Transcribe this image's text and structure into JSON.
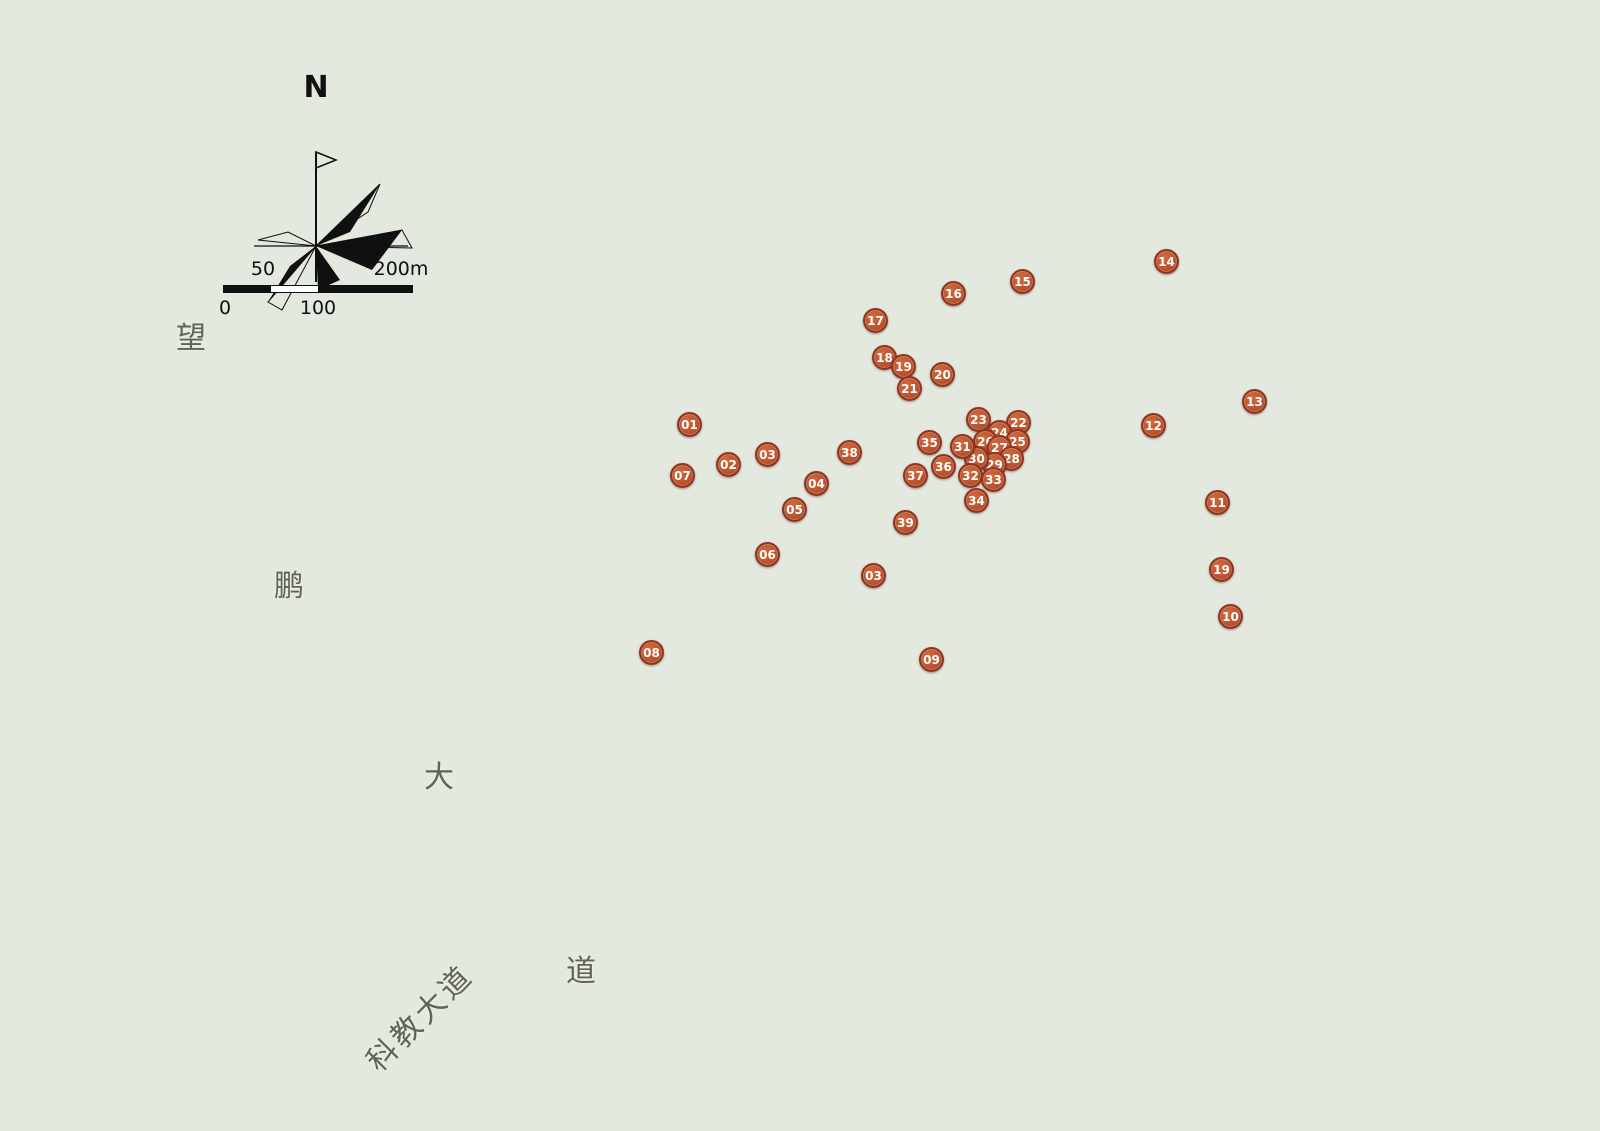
{
  "compass": {
    "north_label": "N"
  },
  "scale_bar": {
    "top_left_label": "50",
    "top_right_label": "200m",
    "bottom_left_label": "0",
    "bottom_mid_label": "100"
  },
  "road_labels": [
    {
      "id": "wang",
      "text": "望",
      "x": 193,
      "y": 335,
      "rotation": 0
    },
    {
      "id": "peng",
      "text": "鹏",
      "x": 291,
      "y": 583,
      "rotation": 0
    },
    {
      "id": "da",
      "text": "大",
      "x": 441,
      "y": 774,
      "rotation": 0
    },
    {
      "id": "dao",
      "text": "道",
      "x": 583,
      "y": 968,
      "rotation": 0
    },
    {
      "id": "kejiao-avenue",
      "text": "科教大道",
      "x": 418,
      "y": 1016,
      "rotation": -45
    }
  ],
  "markers": [
    {
      "label": "01",
      "x": 690,
      "y": 425
    },
    {
      "label": "02",
      "x": 729,
      "y": 465
    },
    {
      "label": "03",
      "x": 768,
      "y": 455
    },
    {
      "label": "03",
      "x": 874,
      "y": 576
    },
    {
      "label": "04",
      "x": 817,
      "y": 484
    },
    {
      "label": "05",
      "x": 795,
      "y": 510
    },
    {
      "label": "06",
      "x": 768,
      "y": 555
    },
    {
      "label": "07",
      "x": 683,
      "y": 476
    },
    {
      "label": "08",
      "x": 652,
      "y": 653
    },
    {
      "label": "09",
      "x": 932,
      "y": 660
    },
    {
      "label": "10",
      "x": 1231,
      "y": 617
    },
    {
      "label": "11",
      "x": 1218,
      "y": 503
    },
    {
      "label": "12",
      "x": 1154,
      "y": 426
    },
    {
      "label": "13",
      "x": 1255,
      "y": 402
    },
    {
      "label": "14",
      "x": 1167,
      "y": 262
    },
    {
      "label": "15",
      "x": 1023,
      "y": 282
    },
    {
      "label": "16",
      "x": 954,
      "y": 294
    },
    {
      "label": "17",
      "x": 876,
      "y": 321
    },
    {
      "label": "18",
      "x": 885,
      "y": 358
    },
    {
      "label": "19",
      "x": 904,
      "y": 367
    },
    {
      "label": "19",
      "x": 1222,
      "y": 570
    },
    {
      "label": "20",
      "x": 943,
      "y": 375
    },
    {
      "label": "21",
      "x": 910,
      "y": 389
    },
    {
      "label": "22",
      "x": 1019,
      "y": 423
    },
    {
      "label": "23",
      "x": 979,
      "y": 420
    },
    {
      "label": "24",
      "x": 1000,
      "y": 433
    },
    {
      "label": "25",
      "x": 1018,
      "y": 442
    },
    {
      "label": "26",
      "x": 986,
      "y": 442
    },
    {
      "label": "27",
      "x": 1000,
      "y": 448
    },
    {
      "label": "28",
      "x": 1012,
      "y": 459
    },
    {
      "label": "29",
      "x": 995,
      "y": 465
    },
    {
      "label": "30",
      "x": 977,
      "y": 459
    },
    {
      "label": "31",
      "x": 963,
      "y": 447
    },
    {
      "label": "32",
      "x": 971,
      "y": 476
    },
    {
      "label": "33",
      "x": 994,
      "y": 480
    },
    {
      "label": "34",
      "x": 977,
      "y": 501
    },
    {
      "label": "35",
      "x": 930,
      "y": 443
    },
    {
      "label": "36",
      "x": 944,
      "y": 467
    },
    {
      "label": "37",
      "x": 916,
      "y": 476
    },
    {
      "label": "38",
      "x": 850,
      "y": 453
    },
    {
      "label": "39",
      "x": 906,
      "y": 523
    }
  ],
  "colors": {
    "marker_fill": "#bc5430",
    "marker_border": "#8e3420",
    "marker_text": "#ffffff",
    "river": "#7fc4e1",
    "flower_pink": "#d793c7",
    "field_yellow": "#d5d149",
    "field_green": "#68994b",
    "road_gray": "#d7dad3",
    "roof_gray": "#595a5e",
    "landmark_purple": "#a264aa",
    "landmark_maroon": "#8e3e36"
  }
}
